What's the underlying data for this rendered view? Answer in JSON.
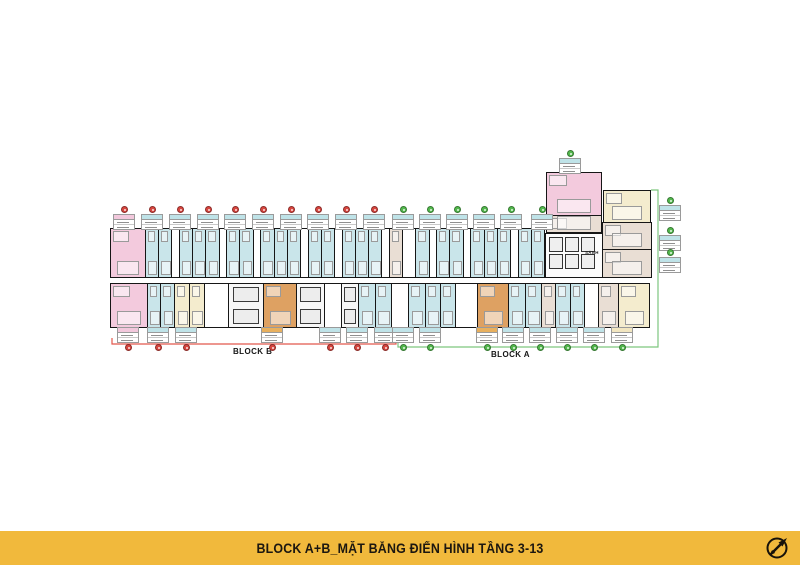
{
  "footer": {
    "title": "BLOCK A+B_MẶT BẰNG ĐIỂN HÌNH TẦNG 3-13",
    "logo": "compass-icon"
  },
  "labels": {
    "block_b": "BLOCK B",
    "block_a": "BLOCK A",
    "lobby": "SẢNH"
  },
  "colors": {
    "pink": "#F3CADD",
    "blue": "#C9E5EA",
    "cream": "#F4ECCE",
    "orange": "#DEA162",
    "beige": "#E9DED4",
    "footer_bg": "#F1B93C",
    "marker_red": "#D8463F",
    "marker_green": "#53B94D",
    "bracket_red": "#E2574C",
    "bracket_green": "#7DC67E",
    "header_teal": "#BFE3E8",
    "header_pink": "#F2C8DC",
    "header_orange": "#E8B05E",
    "header_cream": "#F2E6C0"
  },
  "plan": {
    "rows": [
      {
        "id": "row-top",
        "cells": [
          {
            "w": 36,
            "c": "pink"
          },
          {
            "w": 13,
            "c": "blue"
          },
          {
            "w": 13,
            "c": "blue"
          },
          {
            "w": 7,
            "c": "white"
          },
          {
            "w": 13,
            "c": "blue"
          },
          {
            "w": 13,
            "c": "blue"
          },
          {
            "w": 13,
            "c": "blue"
          },
          {
            "w": 7,
            "c": "white"
          },
          {
            "w": 13,
            "c": "blue"
          },
          {
            "w": 13,
            "c": "blue"
          },
          {
            "w": 7,
            "c": "white"
          },
          {
            "w": 13,
            "c": "blue"
          },
          {
            "w": 13,
            "c": "blue"
          },
          {
            "w": 13,
            "c": "blue"
          },
          {
            "w": 7,
            "c": "white"
          },
          {
            "w": 13,
            "c": "blue"
          },
          {
            "w": 13,
            "c": "blue"
          },
          {
            "w": 7,
            "c": "white"
          },
          {
            "w": 13,
            "c": "blue"
          },
          {
            "w": 13,
            "c": "blue"
          },
          {
            "w": 13,
            "c": "blue"
          },
          {
            "w": 7,
            "c": "white"
          },
          {
            "w": 13,
            "c": "beige"
          },
          {
            "w": 13,
            "c": "white"
          },
          {
            "w": 13,
            "c": "blue"
          },
          {
            "w": 7,
            "c": "white"
          },
          {
            "w": 13,
            "c": "blue"
          },
          {
            "w": 13,
            "c": "blue"
          },
          {
            "w": 7,
            "c": "white"
          },
          {
            "w": 13,
            "c": "blue"
          },
          {
            "w": 13,
            "c": "blue"
          },
          {
            "w": 13,
            "c": "blue"
          },
          {
            "w": 7,
            "c": "white"
          },
          {
            "w": 13,
            "c": "blue"
          },
          {
            "w": 13,
            "c": "blue"
          }
        ]
      },
      {
        "id": "row-bottom",
        "cells": [
          {
            "w": 36,
            "c": "pink"
          },
          {
            "w": 13,
            "c": "blue"
          },
          {
            "w": 13,
            "c": "blue"
          },
          {
            "w": 14,
            "c": "cream"
          },
          {
            "w": 14,
            "c": "cream"
          },
          {
            "w": 24,
            "c": "white"
          },
          {
            "w": 34,
            "c": "gray"
          },
          {
            "w": 32,
            "c": "orange"
          },
          {
            "w": 28,
            "c": "gray"
          },
          {
            "w": 16,
            "c": "white"
          },
          {
            "w": 16,
            "c": "gray"
          },
          {
            "w": 16,
            "c": "blue"
          },
          {
            "w": 16,
            "c": "blue"
          },
          {
            "w": 16,
            "c": "white"
          },
          {
            "w": 16,
            "c": "blue"
          },
          {
            "w": 14,
            "c": "blue"
          },
          {
            "w": 14,
            "c": "blue"
          },
          {
            "w": 22,
            "c": "white"
          },
          {
            "w": 30,
            "c": "orange"
          },
          {
            "w": 16,
            "c": "blue"
          },
          {
            "w": 16,
            "c": "blue"
          },
          {
            "w": 13,
            "c": "beige"
          },
          {
            "w": 14,
            "c": "blue"
          },
          {
            "w": 13,
            "c": "blue"
          },
          {
            "w": 13,
            "c": "white"
          },
          {
            "w": 20,
            "c": "beige"
          },
          {
            "w": 30,
            "c": "cream"
          }
        ]
      }
    ],
    "blocks": [
      {
        "x": 546,
        "y": 172,
        "w": 56,
        "h": 44,
        "c": "pink"
      },
      {
        "x": 546,
        "y": 215,
        "w": 56,
        "h": 18,
        "c": "beige"
      },
      {
        "x": 603,
        "y": 190,
        "w": 48,
        "h": 33,
        "c": "cream"
      },
      {
        "x": 602,
        "y": 222,
        "w": 50,
        "h": 28,
        "c": "beige"
      },
      {
        "x": 602,
        "y": 249,
        "w": 50,
        "h": 29,
        "c": "beige"
      },
      {
        "x": 545,
        "y": 233,
        "w": 58,
        "h": 45,
        "c": "core"
      }
    ],
    "top_markers": {
      "y": 205,
      "items": [
        {
          "x": 124,
          "c": "red",
          "h": "pink"
        },
        {
          "x": 152,
          "c": "red",
          "h": "teal"
        },
        {
          "x": 180,
          "c": "red",
          "h": "teal"
        },
        {
          "x": 208,
          "c": "red",
          "h": "teal"
        },
        {
          "x": 235,
          "c": "red",
          "h": "teal"
        },
        {
          "x": 263,
          "c": "red",
          "h": "teal"
        },
        {
          "x": 291,
          "c": "red",
          "h": "teal"
        },
        {
          "x": 318,
          "c": "red",
          "h": "teal"
        },
        {
          "x": 346,
          "c": "red",
          "h": "teal"
        },
        {
          "x": 374,
          "c": "red",
          "h": "teal"
        },
        {
          "x": 403,
          "c": "green",
          "h": "teal"
        },
        {
          "x": 430,
          "c": "green",
          "h": "teal"
        },
        {
          "x": 457,
          "c": "green",
          "h": "teal"
        },
        {
          "x": 484,
          "c": "green",
          "h": "teal"
        },
        {
          "x": 511,
          "c": "green",
          "h": "teal"
        },
        {
          "x": 542,
          "c": "green",
          "h": "teal"
        }
      ]
    },
    "bottom_markers": {
      "y": 327,
      "items": [
        {
          "x": 128,
          "c": "red",
          "h": "pink"
        },
        {
          "x": 158,
          "c": "red",
          "h": "teal"
        },
        {
          "x": 186,
          "c": "red",
          "h": "teal"
        },
        {
          "x": 272,
          "c": "red",
          "h": "orange"
        },
        {
          "x": 330,
          "c": "red",
          "h": "teal"
        },
        {
          "x": 357,
          "c": "red",
          "h": "teal"
        },
        {
          "x": 385,
          "c": "red",
          "h": "teal"
        },
        {
          "x": 403,
          "c": "green",
          "h": "teal"
        },
        {
          "x": 430,
          "c": "green",
          "h": "teal"
        },
        {
          "x": 487,
          "c": "green",
          "h": "orange"
        },
        {
          "x": 513,
          "c": "green",
          "h": "teal"
        },
        {
          "x": 540,
          "c": "green",
          "h": "teal"
        },
        {
          "x": 567,
          "c": "green",
          "h": "teal"
        },
        {
          "x": 594,
          "c": "green",
          "h": "teal"
        },
        {
          "x": 622,
          "c": "green",
          "h": "cream"
        }
      ]
    },
    "side_markers": [
      {
        "x": 670,
        "y": 196,
        "c": "green",
        "h": "teal"
      },
      {
        "x": 670,
        "y": 226,
        "c": "green",
        "h": "teal"
      },
      {
        "x": 670,
        "y": 248,
        "c": "green",
        "h": "teal"
      },
      {
        "x": 570,
        "y": 149,
        "c": "green",
        "h": "teal"
      }
    ]
  }
}
